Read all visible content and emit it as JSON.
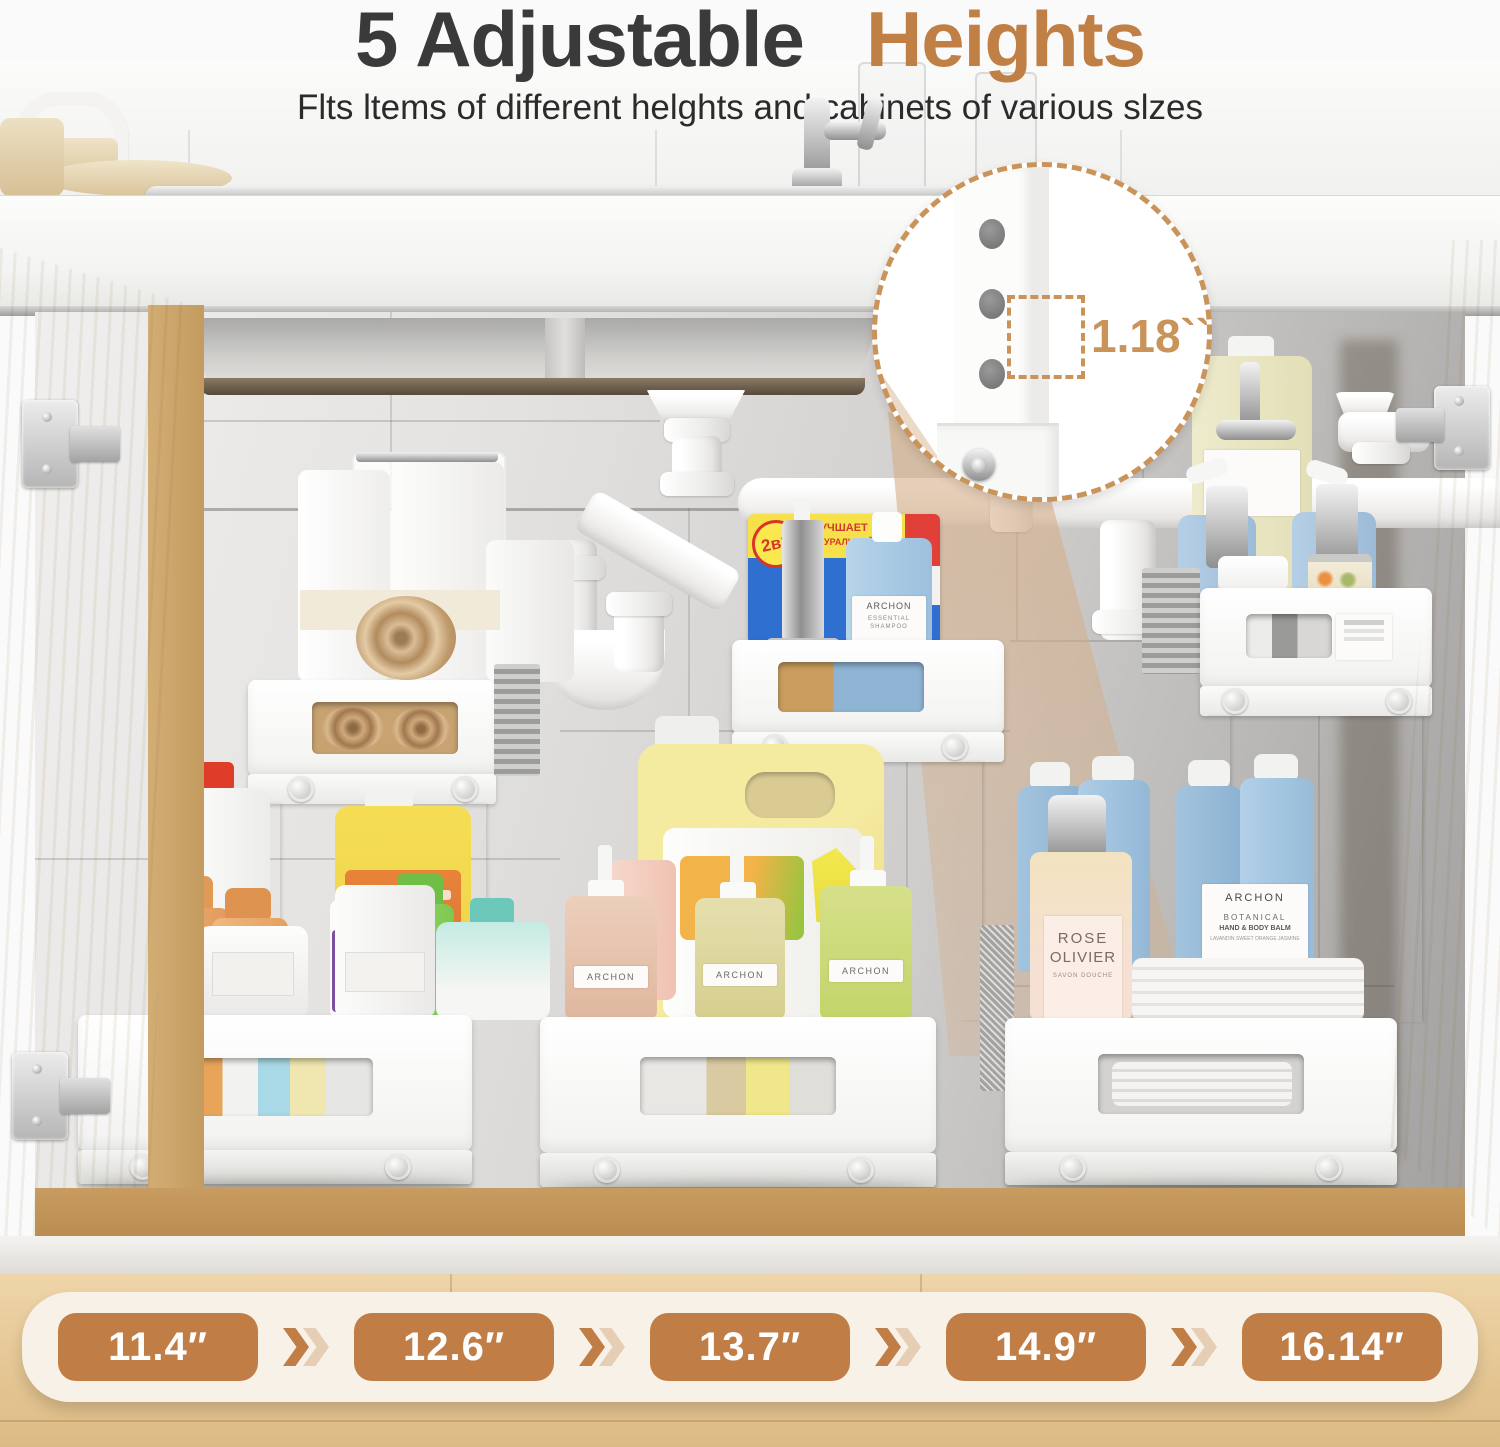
{
  "header": {
    "title_dark": "5 Adjustable",
    "title_accent": "Heights",
    "subtitle": "Flts ltems of different helghts and cabinets of various slzes"
  },
  "callout": {
    "measurement": "1.18``"
  },
  "size_bar": {
    "sizes": [
      "11.4″",
      "12.6″",
      "13.7″",
      "14.9″",
      "16.14″"
    ]
  },
  "products": {
    "archon": "ARCHON",
    "shampoo_line1": "ESSENTIAL",
    "shampoo_line2": "SHAMPOO",
    "botanical_brand": "ARCHON",
    "botanical_line1": "BOTANICAL",
    "botanical_line2": "HAND & BODY BALM",
    "botanical_line3": "LAVANDIN SWEET ORANGE JASMINE",
    "rose_line1": "ROSE",
    "rose_line2": "OLIVIER",
    "rose_sub": "SAVON DOUCHE",
    "two_in_one": "2в1",
    "box_line1": "УЛУЧШАЕТ",
    "box_line2": "НАТУРАЛЬНОЙ МАШИНЫ"
  },
  "colors": {
    "accent": "#c08045",
    "pill": "#c07e46",
    "bar_bg": "#f8f1e8",
    "dashed": "#c9935a"
  }
}
